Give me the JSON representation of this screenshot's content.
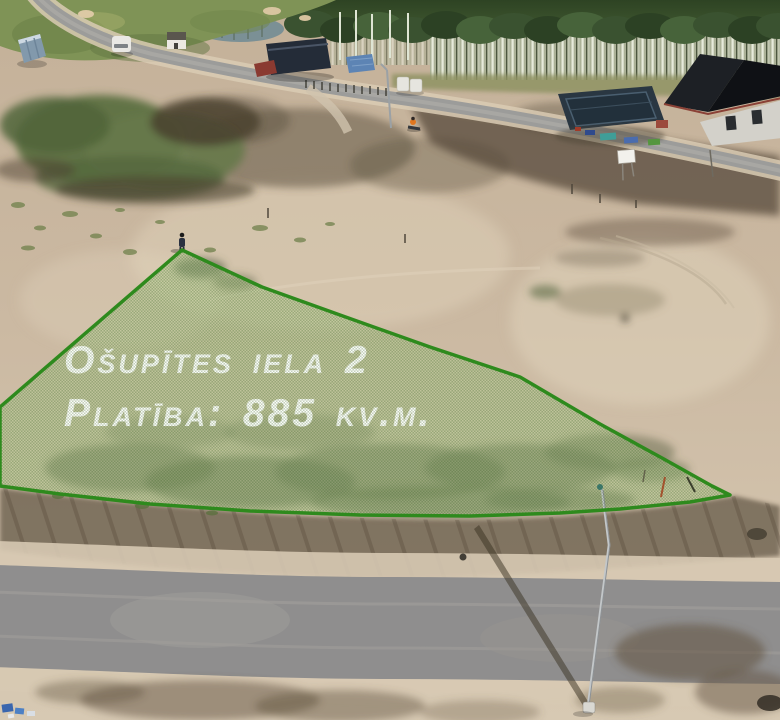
{
  "overlay": {
    "street_line": "Ošupītes iela 2",
    "street_display": "OŠUPĪTES IELA 2",
    "area_line": "Platība: 885 kv.m.",
    "area_display": "PLATĪBA: 885 KV.M.",
    "area_value": "885",
    "area_unit": "kv.m.",
    "street_number": "2",
    "colors": {
      "outline": "#2e8a1d",
      "fill_tint": "#9cc27a",
      "hatch": "#2f6020",
      "text": "#ffffff"
    }
  },
  "scene_palette": {
    "sand": "#ccbaa3",
    "dark_soil": "#5f5242",
    "grass": "#5c7040",
    "forest": "#3a5230",
    "asphalt_road": "#8f8e8e",
    "house_roof": "#17191d",
    "cabin": "#242c38",
    "tarp_blue": "#5d84b4"
  }
}
